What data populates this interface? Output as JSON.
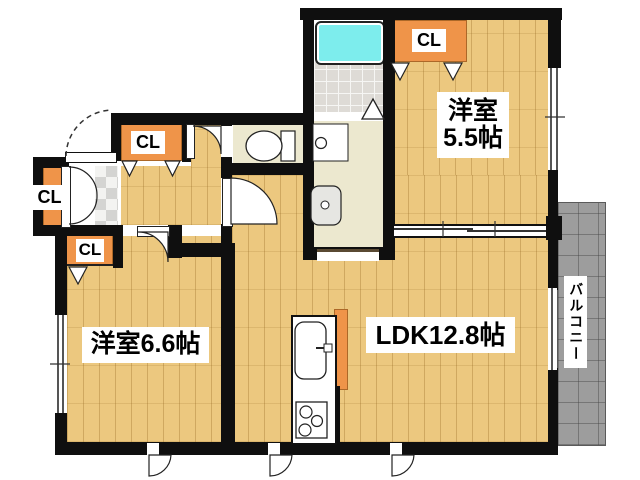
{
  "floorplan": {
    "rooms": {
      "bedroom_upper": {
        "name": "洋室",
        "size": "5.5帖"
      },
      "bedroom_lower": {
        "label": "洋室6.6帖"
      },
      "ldk": {
        "label": "LDK12.8帖"
      },
      "balcony": {
        "label": "バルコニー"
      }
    },
    "closet_label": "CL",
    "colors": {
      "wall": "#0F0F0F",
      "wood_floor": "#ECC87F",
      "service_floor": "#ECE8CF",
      "closet_orange": "#EF9449",
      "bathtub_cyan": "#7DEDED",
      "balcony_gray": "#9D9D9D"
    }
  }
}
